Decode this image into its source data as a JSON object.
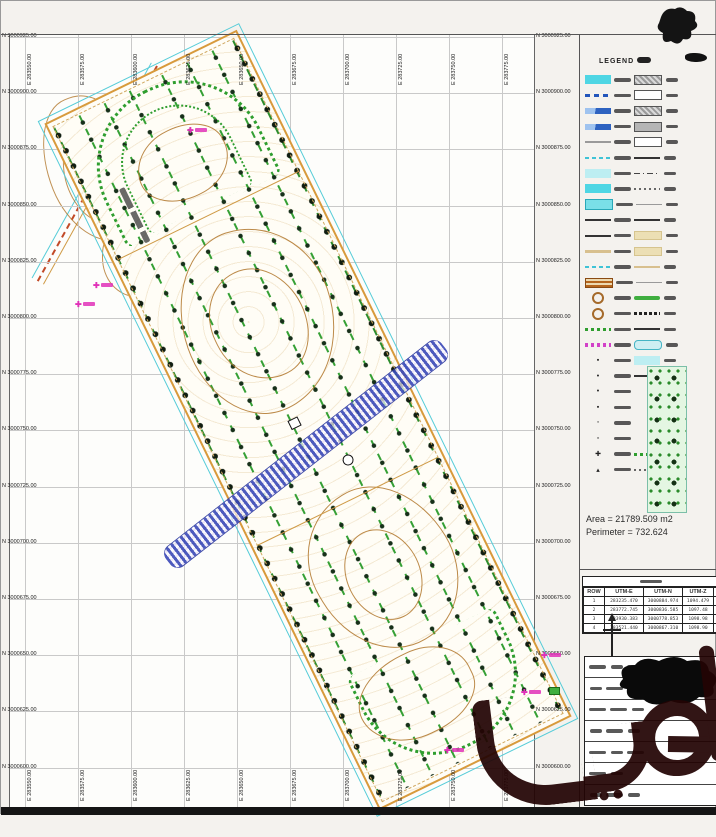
{
  "drawing": {
    "type": "cadastral-survey-site-plan",
    "site_annotation": "ساختمان فاقد",
    "watermark_text": "دیوار"
  },
  "frame": {
    "northings": [
      "N 3000925.00",
      "N 3000900.00",
      "N 3000875.00",
      "N 3000850.00",
      "N 3000825.00",
      "N 3000800.00",
      "N 3000775.00",
      "N 3000750.00",
      "N 3000725.00",
      "N 3000700.00",
      "N 3000675.00",
      "N 3000650.00",
      "N 3000625.00",
      "N 3000600.00"
    ],
    "eastings": [
      "E 283550.00",
      "E 283575.00",
      "E 283600.00",
      "E 283625.00",
      "E 283650.00",
      "E 283675.00",
      "E 283700.00",
      "E 283725.00",
      "E 283750.00",
      "E 283775.00"
    ]
  },
  "legend": {
    "title": "LEGEND",
    "rows": [
      {
        "c1": "cy",
        "c2": "rch"
      },
      {
        "c1": "bld",
        "c2": "rcw"
      },
      {
        "c1": "bls",
        "c2": "rch"
      },
      {
        "c1": "bls",
        "c2": "rcg"
      },
      {
        "c1": "gyl",
        "c2": "rcw"
      },
      {
        "c1": "cyd",
        "c2": "dkl"
      },
      {
        "c1": "cyp",
        "c2": "dd"
      },
      {
        "c1": "cy",
        "c2": "dot"
      },
      {
        "c1": "cyb",
        "c2": "gyl"
      },
      {
        "c1": "dkl",
        "c2": "arr"
      },
      {
        "c1": "dkl",
        "c2": "tnb"
      },
      {
        "c1": "tnl",
        "c2": "tnb"
      },
      {
        "c1": "cyd",
        "c2": "tnl"
      },
      {
        "c1": "hat",
        "c2": "gyl"
      },
      {
        "c1": "rng",
        "c2": "grl"
      },
      {
        "c1": "rng",
        "c2": "zig"
      },
      {
        "c1": "gdt",
        "c2": "dkl"
      },
      {
        "c1": "mgd",
        "c2": "cap"
      },
      {
        "g1": "▪",
        "c2": "cyp"
      },
      {
        "g1": "•",
        "c2": "dkl"
      },
      {
        "g1": "•",
        "c2": "none"
      },
      {
        "g1": "▪",
        "c2": "none"
      },
      {
        "g1": "◦",
        "c2": "none"
      },
      {
        "g1": "▫",
        "c2": "none"
      },
      {
        "g1": "✚",
        "c2": "gdt"
      },
      {
        "g1": "▴",
        "c2": "dot"
      }
    ]
  },
  "stats": {
    "area": "Area = 21789.509 m2",
    "perimeter": "Perimeter = 732.624"
  },
  "coord_table": {
    "title": "مختصات",
    "headers": [
      "ROW",
      "UTM-E",
      "UTM-N",
      "UTM-Z"
    ],
    "rows": [
      [
        "1",
        "283235.470",
        "3000884.974",
        "1094.479"
      ],
      [
        "2",
        "283772.745",
        "3000836.585",
        "1097.48"
      ],
      [
        "3",
        "283930.383",
        "3000778.853",
        "1098.98"
      ],
      [
        "4",
        "283521.440",
        "3000867.310",
        "1098.90"
      ]
    ]
  },
  "markers": [
    {
      "x": 92,
      "y": 281
    },
    {
      "x": 186,
      "y": 126
    },
    {
      "x": 74,
      "y": 300
    },
    {
      "x": 443,
      "y": 746
    },
    {
      "x": 520,
      "y": 688
    },
    {
      "x": 540,
      "y": 651
    }
  ],
  "colors": {
    "contour": "#b0762a",
    "tree_row_green": "#35a035",
    "river_blue": "#3a49b8",
    "cyan_line": "#55ccd8",
    "marker_magenta": "#e031b8",
    "watermark_maroon": "#230404"
  }
}
